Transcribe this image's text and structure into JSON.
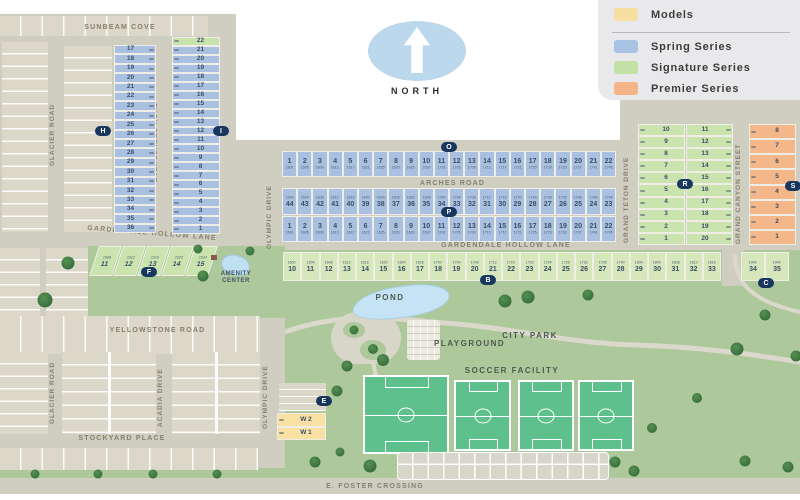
{
  "legend": {
    "items": [
      {
        "name": "models",
        "label": "Models",
        "color": "#f7dfa2"
      },
      {
        "name": "spring",
        "label": "Spring Series",
        "color": "#a9c3e4"
      },
      {
        "name": "signature",
        "label": "Signature Series",
        "color": "#c3e0a7"
      },
      {
        "name": "premier",
        "label": "Premier Series",
        "color": "#f5b588"
      }
    ]
  },
  "north": {
    "label": "NORTH"
  },
  "streets": {
    "sunbeam": "SUNBEAM COVE",
    "glacier": "GLACIER ROAD",
    "everglades": "EVERGLADES ROAD",
    "gardendale1": "GARDENDALE HOLLOW LANE",
    "gardendale2": "GARDENDALE HOLLOW LANE",
    "olympic1": "OLYMPIC DRIVE",
    "olympic2": "OLYMPIC DRIVE",
    "arches": "ARCHES ROAD",
    "grand_teton": "GRAND TETON DRIVE",
    "grand_canyon": "GRAND CANYON STREET",
    "yellowstone": "YELLOWSTONE ROAD",
    "glacier2": "GLACIER ROAD",
    "acadia": "ACADIA DRIVE",
    "stockyard": "STOCKYARD PLACE",
    "foster": "E. FOSTER CROSSING"
  },
  "amenities": {
    "pond": "POND",
    "city_park": "CITY PARK",
    "playground": "PLAYGROUND",
    "soccer": "SOCCER FACILITY",
    "amenity_line1": "AMENITY",
    "amenity_line2": "CENTER"
  },
  "sections": {
    "h_col": {
      "lots": [
        17,
        18,
        19,
        20,
        21,
        22,
        23,
        24,
        25,
        26,
        27,
        28,
        29,
        30,
        31,
        32,
        33,
        34,
        35,
        36
      ]
    },
    "i_col": {
      "lots": [
        22,
        21,
        20,
        19,
        18,
        17,
        16,
        15,
        14,
        13,
        12,
        11,
        10,
        9,
        8,
        7,
        6,
        5,
        4,
        3,
        2,
        1
      ]
    },
    "row_o": {
      "lots": [
        1,
        2,
        3,
        4,
        5,
        6,
        7,
        8,
        9,
        10,
        11,
        12,
        13,
        14,
        15,
        16,
        17,
        18,
        19,
        20,
        21,
        22
      ],
      "addresses": [
        "1601",
        "1605",
        "1609",
        "1613",
        "1617",
        "1621",
        "1625",
        "1629",
        "1633",
        "1637",
        "1701",
        "1705",
        "1709",
        "1713",
        "1717",
        "1721",
        "1725",
        "1729",
        "1733",
        "1737",
        "1741",
        "1745"
      ]
    },
    "row_mid": {
      "lots": [
        44,
        43,
        42,
        41,
        40,
        39,
        38,
        37,
        36,
        35,
        34,
        33,
        32,
        31,
        30,
        29,
        28,
        27,
        26,
        25,
        24,
        23
      ],
      "addresses": [
        "1600",
        "1604",
        "1608",
        "1612",
        "1616",
        "1620",
        "1624",
        "1628",
        "1632",
        "1636",
        "1700",
        "1704",
        "1708",
        "1712",
        "1716",
        "1720",
        "1724",
        "1728",
        "1732",
        "1736",
        "1740",
        "1744"
      ]
    },
    "row_p": {
      "lots": [
        1,
        2,
        3,
        4,
        5,
        6,
        7,
        8,
        9,
        10,
        11,
        12,
        13,
        14,
        15,
        16,
        17,
        18,
        19,
        20,
        21,
        22
      ],
      "addresses": [
        "1601",
        "1605",
        "1609",
        "1613",
        "1617",
        "1621",
        "1625",
        "1629",
        "1633",
        "1637",
        "1701",
        "1705",
        "1709",
        "1713",
        "1717",
        "1721",
        "1725",
        "1729",
        "1733",
        "1737",
        "1741",
        "1745"
      ]
    },
    "row_e": {
      "lots": [
        10,
        11,
        12,
        13,
        14,
        15,
        16,
        17,
        18,
        19,
        20,
        21,
        22,
        23,
        24,
        25,
        26,
        27,
        28,
        29,
        30,
        31,
        32,
        33
      ],
      "addresses": [
        "1600",
        "1604",
        "1608",
        "1612",
        "1616",
        "1620",
        "1624",
        "1628",
        "1700",
        "1704",
        "1708",
        "1712",
        "1716",
        "1720",
        "1724",
        "1728",
        "1732",
        "1736",
        "1740",
        "1800",
        "1804",
        "1808",
        "1812",
        "1816"
      ]
    },
    "row_e2": {
      "lots": [
        34,
        35
      ],
      "addresses": [
        "1900",
        "1904"
      ]
    },
    "f_lots": {
      "lots": [
        11,
        12,
        13,
        14,
        15
      ],
      "addresses": [
        "1508",
        "1512",
        "1516",
        "1520",
        "1524"
      ]
    },
    "r_left": {
      "lots": [
        10,
        9,
        8,
        7,
        6,
        5,
        4,
        3,
        2,
        1
      ]
    },
    "r_right": {
      "lots": [
        11,
        12,
        13,
        14,
        15,
        16,
        17,
        18,
        19,
        20
      ]
    },
    "s_col": {
      "lots": [
        8,
        7,
        6,
        5,
        4,
        3,
        2,
        1
      ]
    },
    "models": {
      "lots": [
        "W 2",
        "W 1"
      ]
    }
  },
  "markers": [
    {
      "letter": "H",
      "x": 103,
      "y": 131
    },
    {
      "letter": "I",
      "x": 221,
      "y": 131
    },
    {
      "letter": "O",
      "x": 449,
      "y": 147
    },
    {
      "letter": "P",
      "x": 449,
      "y": 212
    },
    {
      "letter": "F",
      "x": 149,
      "y": 272
    },
    {
      "letter": "B",
      "x": 488,
      "y": 280
    },
    {
      "letter": "C",
      "x": 766,
      "y": 283
    },
    {
      "letter": "E",
      "x": 324,
      "y": 401
    },
    {
      "letter": "R",
      "x": 685,
      "y": 184
    },
    {
      "letter": "S",
      "x": 793,
      "y": 186
    }
  ],
  "trees": [
    [
      68,
      263,
      13
    ],
    [
      45,
      300,
      15
    ],
    [
      203,
      276,
      11
    ],
    [
      250,
      251,
      9
    ],
    [
      198,
      249,
      9
    ],
    [
      505,
      301,
      13
    ],
    [
      528,
      297,
      13
    ],
    [
      588,
      295,
      11
    ],
    [
      765,
      315,
      11
    ],
    [
      737,
      349,
      13
    ],
    [
      796,
      356,
      11
    ],
    [
      383,
      360,
      12
    ],
    [
      347,
      366,
      11
    ],
    [
      337,
      391,
      11
    ],
    [
      354,
      330,
      9
    ],
    [
      373,
      349,
      10
    ],
    [
      35,
      474,
      9
    ],
    [
      98,
      474,
      9
    ],
    [
      153,
      474,
      9
    ],
    [
      217,
      474,
      9
    ],
    [
      315,
      462,
      11
    ],
    [
      340,
      452,
      9
    ],
    [
      370,
      466,
      13
    ],
    [
      615,
      462,
      11
    ],
    [
      634,
      471,
      11
    ],
    [
      745,
      461,
      11
    ],
    [
      788,
      467,
      11
    ],
    [
      652,
      428,
      10
    ],
    [
      697,
      398,
      10
    ]
  ]
}
